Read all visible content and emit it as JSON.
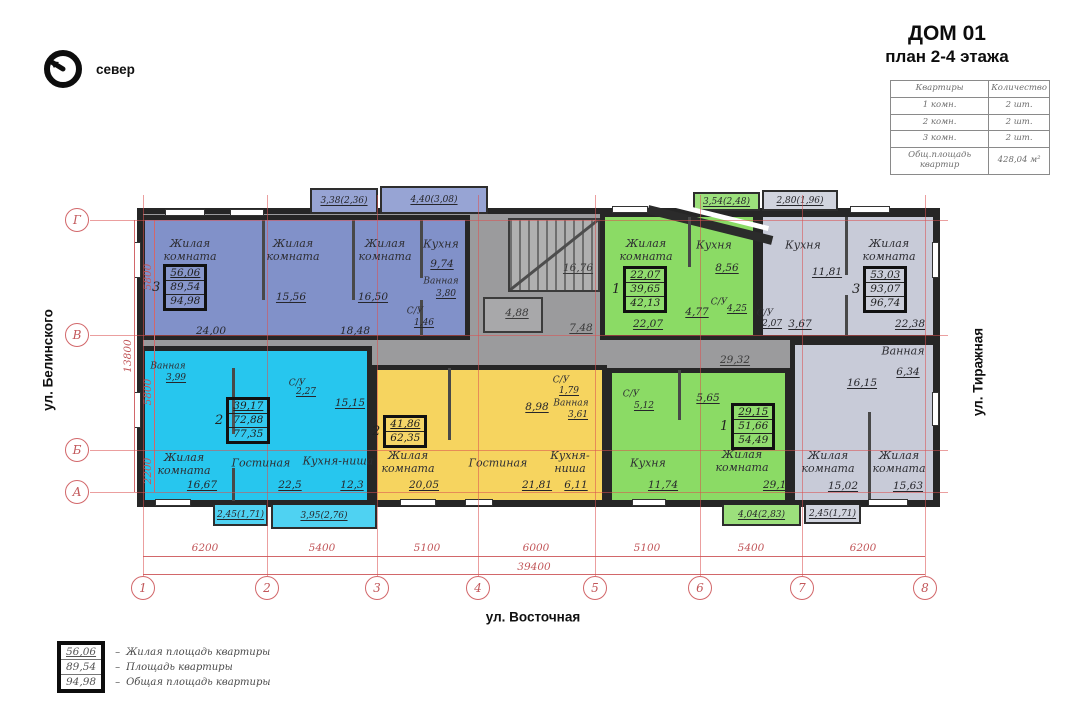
{
  "title": {
    "line1": "ДОМ 01",
    "line2": "план 2-4 этажа"
  },
  "compass": {
    "label": "север"
  },
  "info_table": {
    "headers": [
      "Квартиры",
      "Количество"
    ],
    "rows": [
      {
        "type": "1 комн.",
        "count": "2 шт."
      },
      {
        "type": "2 комн.",
        "count": "2 шт."
      },
      {
        "type": "3 комн.",
        "count": "2 шт."
      }
    ],
    "footer": {
      "label": "Общ.площадь квартир",
      "value": "428,04 м²"
    }
  },
  "streets": {
    "left": "ул. Белинского",
    "right": "ул. Тиражная",
    "bottom": "ул. Восточная"
  },
  "grid": {
    "columns": [
      "1",
      "2",
      "3",
      "4",
      "5",
      "6",
      "7",
      "8"
    ],
    "column_dims": [
      "6200",
      "5400",
      "5100",
      "6000",
      "5100",
      "5400",
      "6200"
    ],
    "column_total": "39400",
    "rows": [
      "Г",
      "В",
      "Б",
      "А"
    ],
    "row_dims": [
      "5800",
      "5800",
      "2200"
    ],
    "row_total": "13800"
  },
  "common_areas": {
    "stairs": "16,76",
    "elevator": "4,88",
    "corridor_right": "7,48",
    "corridor_lower": "29,32"
  },
  "apartments": {
    "blue3": {
      "label": "3",
      "stats": [
        "56,06",
        "89,54",
        "94,98"
      ],
      "rooms": [
        {
          "name": "Жилая комната",
          "area": "24,00"
        },
        {
          "name": "Жилая комната",
          "area": "15,56"
        },
        {
          "name": "Жилая комната",
          "area": "16,50"
        },
        {
          "name": "Кухня",
          "area": "9,74"
        },
        {
          "name": "Ванная",
          "area": "3,80"
        },
        {
          "name": "С/У",
          "area": "1,46"
        },
        {
          "area": "18,48"
        }
      ]
    },
    "green1top": {
      "label": "1",
      "stats": [
        "22,07",
        "39,65",
        "42,13"
      ],
      "rooms": [
        {
          "name": "Жилая комната",
          "area": "22,07"
        },
        {
          "name": "Кухня",
          "area": "8,56"
        },
        {
          "name": "С/У",
          "area": "4,25"
        },
        {
          "area": "4,77"
        }
      ]
    },
    "gray3": {
      "label": "3",
      "stats": [
        "53,03",
        "93,07",
        "96,74"
      ],
      "rooms": [
        {
          "name": "Кухня",
          "area": "11,81"
        },
        {
          "name": "Жилая комната",
          "area": "22,38"
        },
        {
          "name": "С/У",
          "area": "2,07"
        },
        {
          "area": "3,67"
        },
        {
          "name": "Ванная",
          "area": "6,34"
        },
        {
          "area": "16,15"
        },
        {
          "name": "Жилая комната",
          "area": "15,02"
        },
        {
          "name": "Жилая комната",
          "area": "15,63"
        }
      ]
    },
    "cyan2": {
      "label": "2",
      "stats": [
        "39,17",
        "72,88",
        "77,35"
      ],
      "rooms": [
        {
          "name": "Ванная",
          "area": "3,99"
        },
        {
          "name": "С/У",
          "area": "2,27"
        },
        {
          "area": "15,15"
        },
        {
          "name": "Жилая комната",
          "area": "16,67"
        },
        {
          "name": "Гостиная",
          "area": "22,5"
        },
        {
          "name": "Кухня-ниша",
          "area": "12,3"
        }
      ]
    },
    "yellow2": {
      "label": "2",
      "stats": [
        "41,86",
        "62,35"
      ],
      "rooms": [
        {
          "name": "Жилая комната",
          "area": "20,05"
        },
        {
          "name": "Гостиная",
          "area": "21,81"
        },
        {
          "name": "Кухня-ниша",
          "area": "6,11"
        },
        {
          "name": "Ванная",
          "area": "3,61"
        },
        {
          "name": "С/У",
          "area": "1,79"
        },
        {
          "area": "8,98"
        }
      ]
    },
    "green1bottom": {
      "label": "1",
      "stats": [
        "29,15",
        "51,66",
        "54,49"
      ],
      "rooms": [
        {
          "name": "Жилая комната",
          "area": "29,15"
        },
        {
          "name": "Кухня",
          "area": "11,74"
        },
        {
          "name": "С/У",
          "area": "5,12"
        },
        {
          "area": "5,65"
        }
      ]
    }
  },
  "balconies": {
    "top": [
      "3,38(2,36)",
      "4,40(3,08)",
      "3,54(2,48)",
      "2,80(1,96)"
    ],
    "bottom": [
      "2,45(1,71)",
      "3,95(2,76)",
      "4,04(2,83)",
      "2,45(1,71)"
    ]
  },
  "legend": {
    "separator": "–",
    "values": [
      "56,06",
      "89,54",
      "94,98"
    ],
    "labels": [
      "Жилая площадь квартиры",
      "Площадь квартиры",
      "Общая площадь квартиры"
    ]
  },
  "colors": {
    "blue": "#8191c9",
    "cyan": "#27c6ee",
    "yellow": "#f6d45f",
    "green": "#8bdb65",
    "gray_apartment": "#c8cbd8",
    "common_gray": "#9b9b9d",
    "wall": "#262626",
    "dimension": "#d2676a"
  }
}
